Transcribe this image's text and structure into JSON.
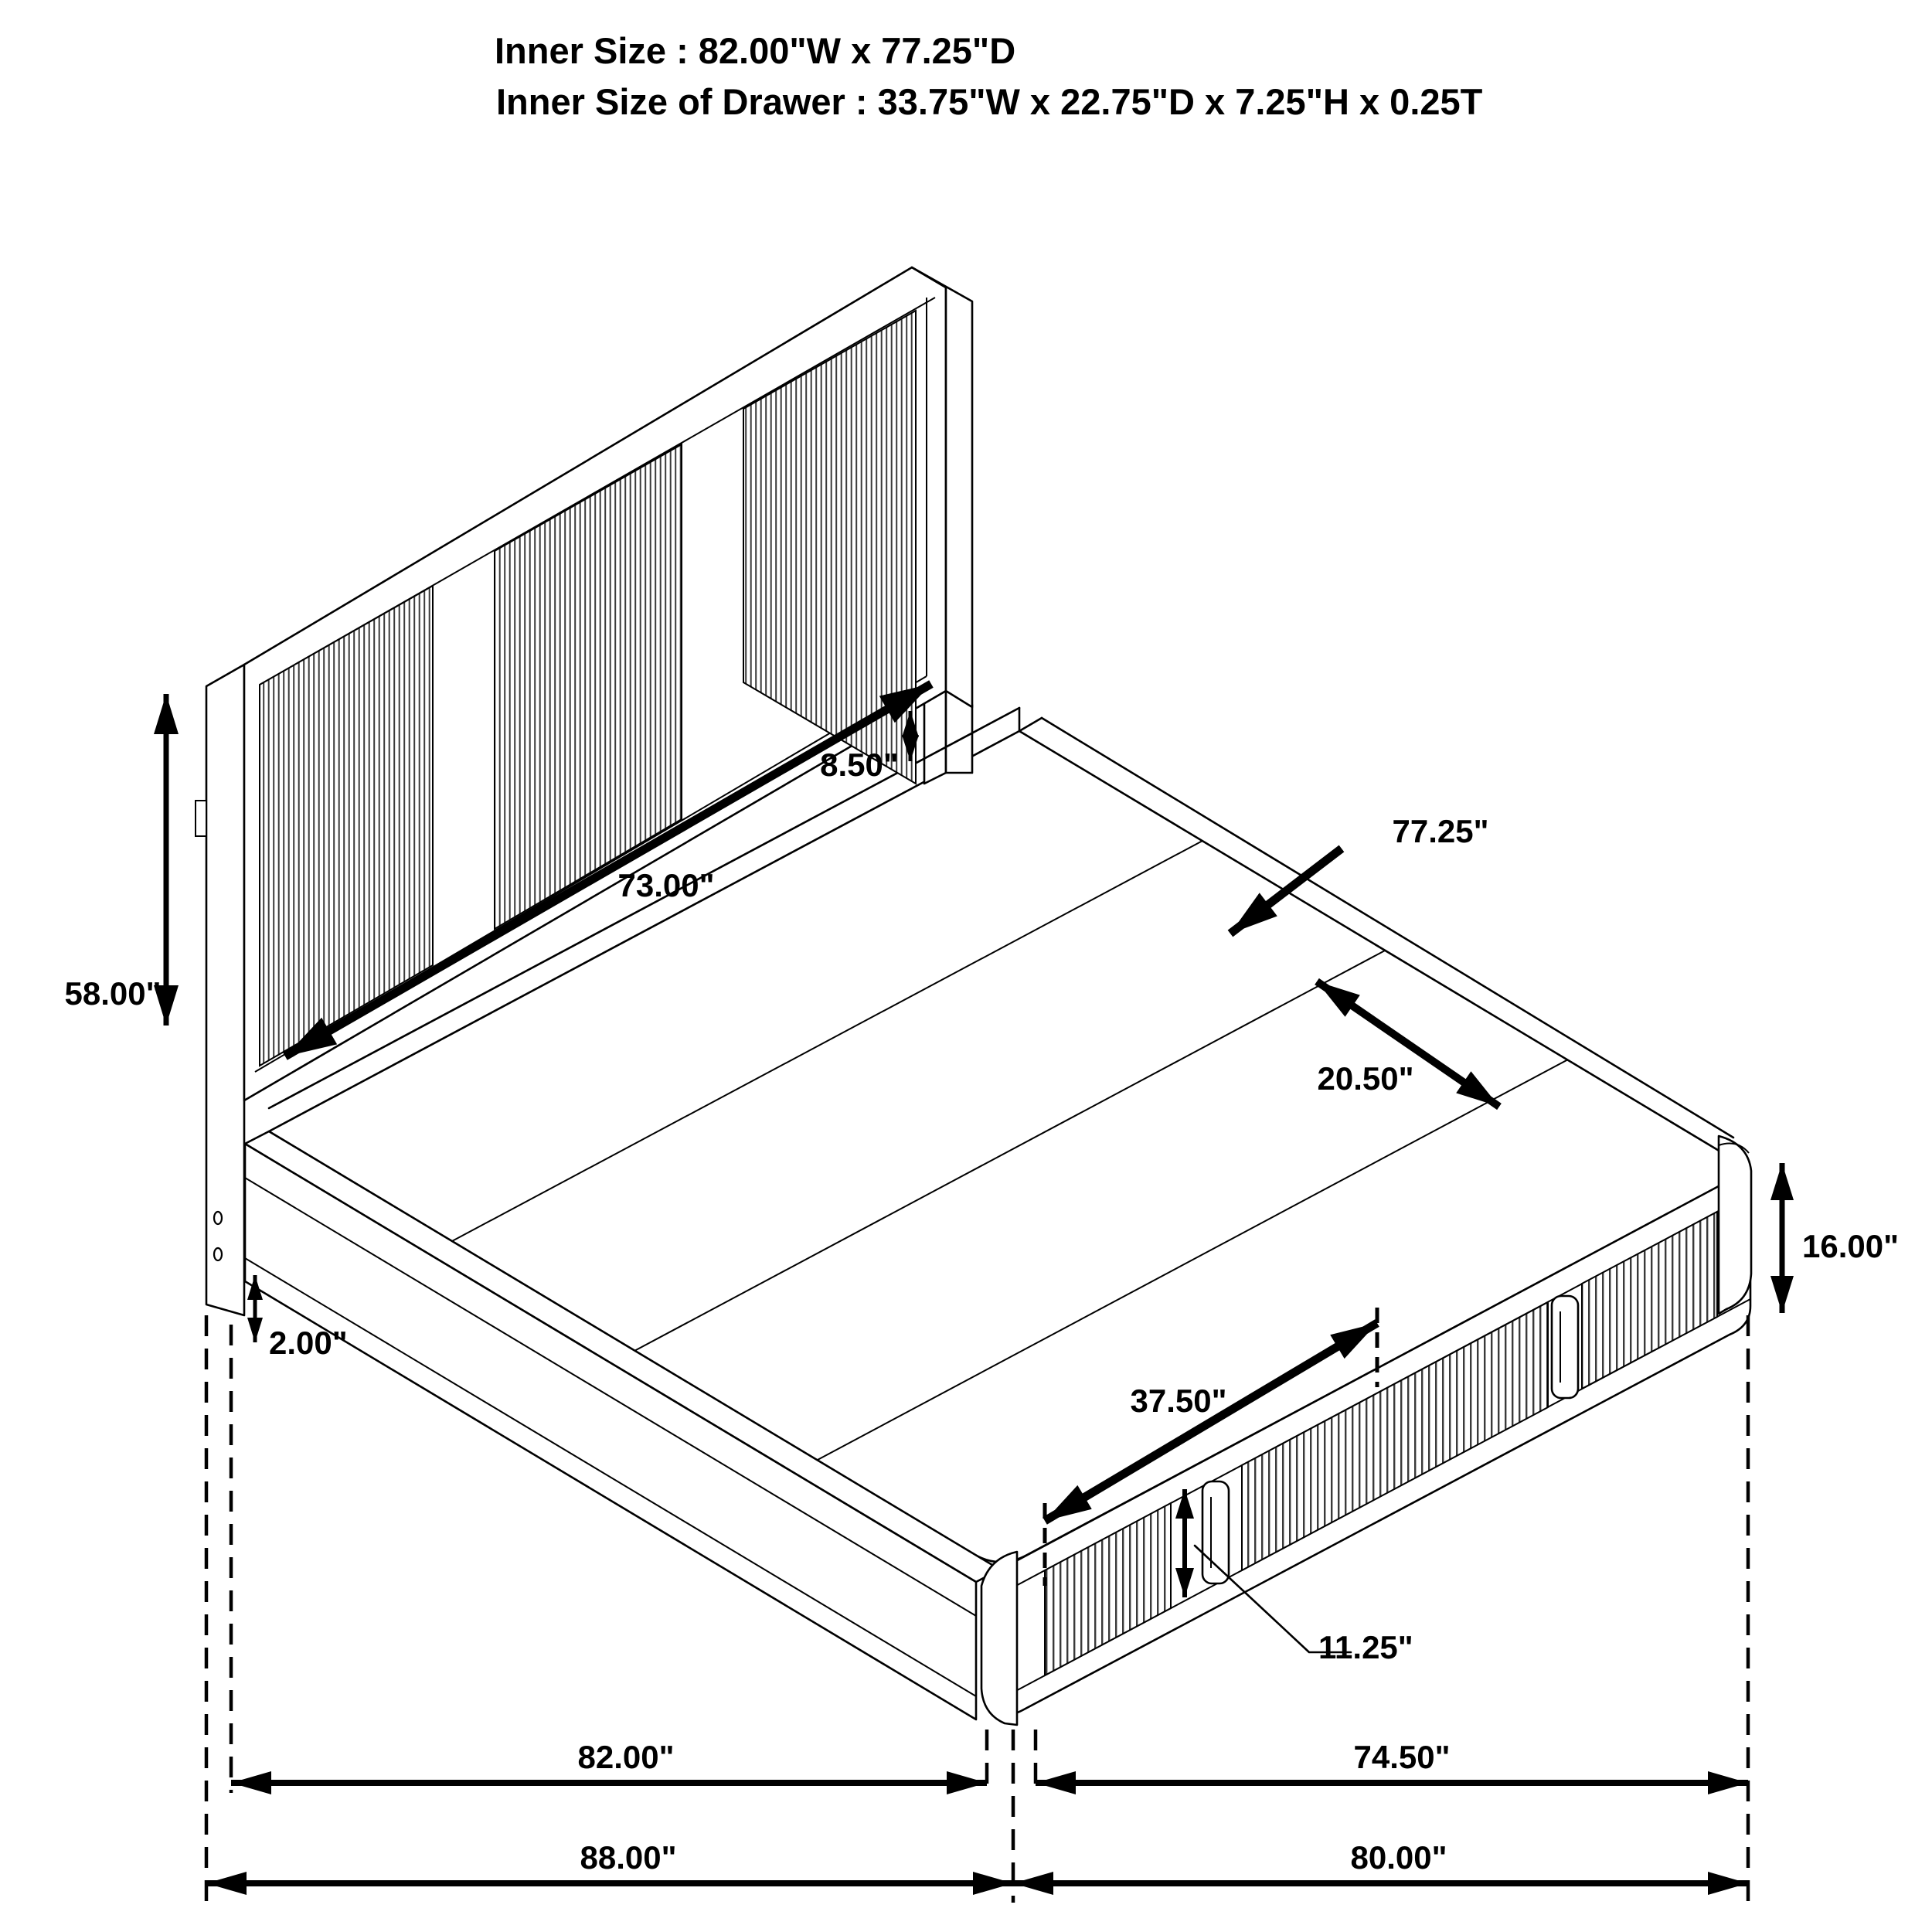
{
  "header": {
    "line1": "Inner Size : 82.00\"W x 77.25\"D",
    "line2": "Inner Size of Drawer : 33.75\"W x 22.75\"D x 7.25\"H x 0.25T"
  },
  "dimensions": {
    "headboard_height": "58.00\"",
    "headboard_rail_gap": "8.50\"",
    "headboard_panel_width": "73.00\"",
    "platform_depth": "77.25\"",
    "deck_board_width": "20.50\"",
    "footboard_height": "16.00\"",
    "floor_clearance": "2.00\"",
    "drawer_front_span": "37.50\"",
    "drawer_stile_height": "11.25\"",
    "inner_width": "82.00\"",
    "footboard_side_width": "74.50\"",
    "overall_width": "88.00\"",
    "overall_side_depth": "80.00\""
  },
  "colors": {
    "line": "#000000",
    "background": "#ffffff",
    "rib": "#3a3a3a"
  }
}
